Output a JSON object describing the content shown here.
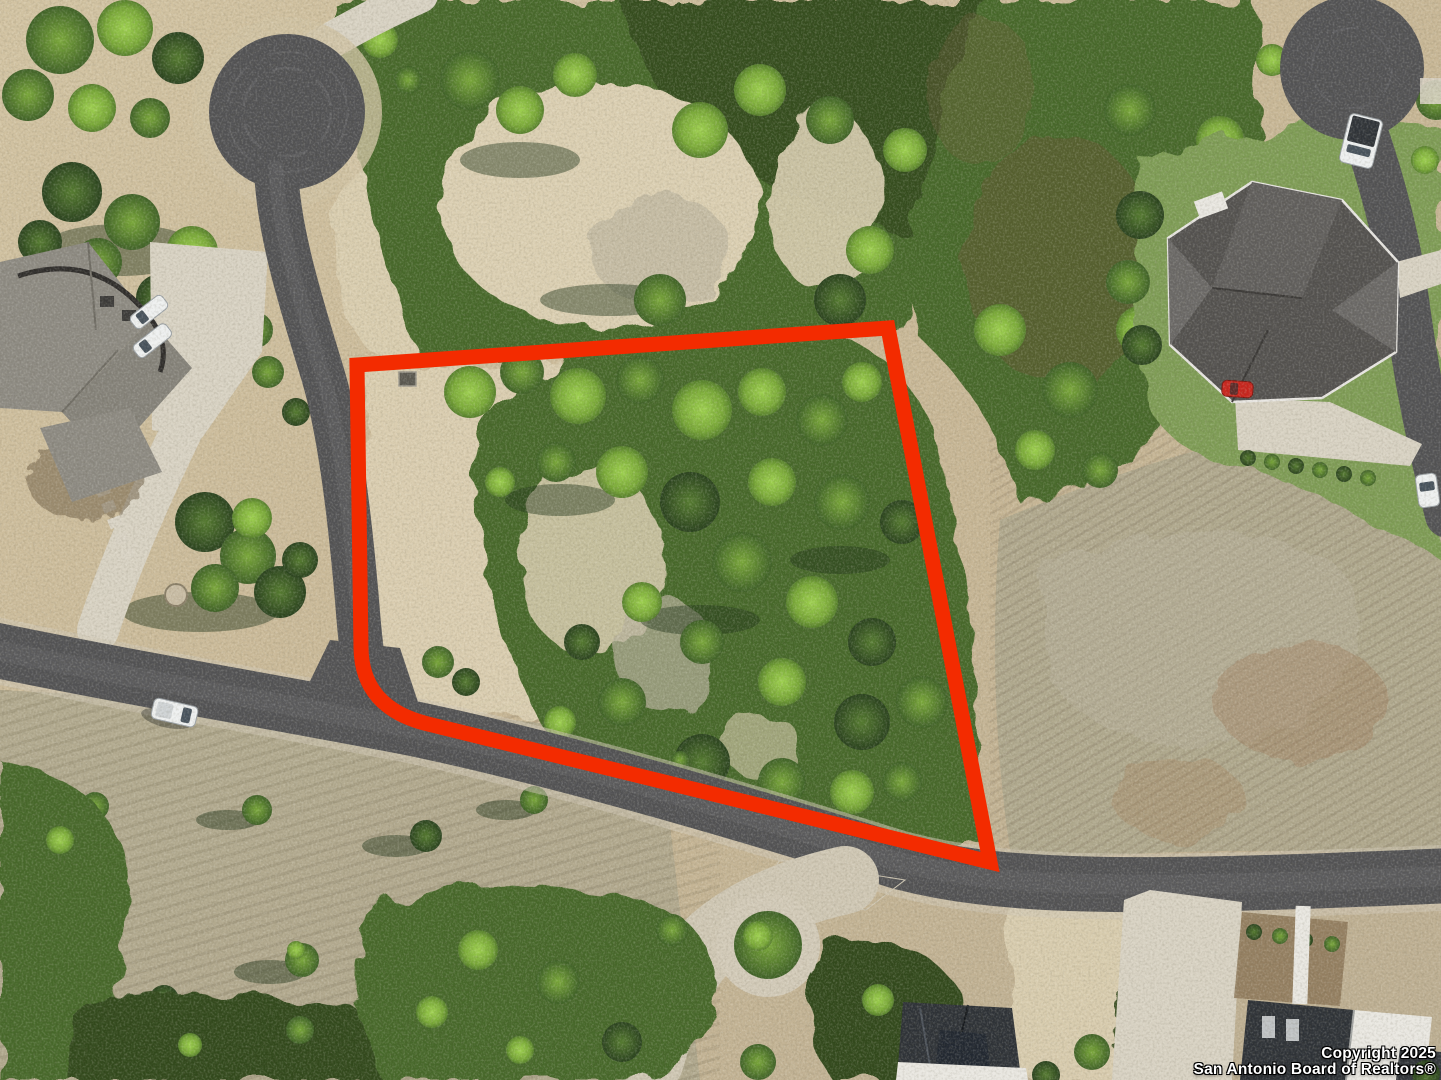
{
  "image": {
    "type": "aerial-drone-photo",
    "subject": "Vacant wooded residential lot for sale, outlined in red, Texas hill-country subdivision",
    "width": 1441,
    "height": 1080
  },
  "watermark": {
    "line1": "Copyright 2025",
    "line2": "San Antonio Board of Realtors®",
    "text_color": "#ffffff"
  },
  "lot_boundary": {
    "color": "#f32b00",
    "stroke_width": 15,
    "path": "M357,365 L888,328 L990,862 L428,724 Q362,708 361,648 L357,365 Z"
  },
  "colors": {
    "asphalt": "#525254",
    "concrete": "#d8d2c3",
    "dirt": "#c9b897",
    "tree_bright": "#8cc043",
    "tree_dark": "#2c4720",
    "lawn": "#7e9c55"
  },
  "scene": {
    "roads": [
      {
        "name": "cul-de-sac-top-left",
        "shape": "bulb",
        "center": [
          287,
          112
        ]
      },
      {
        "name": "street-north-south",
        "from": [
          276,
          168
        ],
        "to": [
          372,
          706
        ]
      },
      {
        "name": "street-main-diagonal",
        "from": [
          0,
          648
        ],
        "to": [
          1441,
          876
        ]
      },
      {
        "name": "cul-de-sac-top-right",
        "shape": "bulb",
        "center": [
          1352,
          68
        ]
      },
      {
        "name": "street-right-edge",
        "from": [
          1352,
          95
        ],
        "to": [
          1441,
          510
        ]
      }
    ],
    "houses": [
      {
        "name": "house-left",
        "roof": "gray-shingle",
        "area": [
          0,
          235,
          200,
          500
        ]
      },
      {
        "name": "house-top-right",
        "roof": "dark-gray-shingle",
        "area": [
          1165,
          180,
          1400,
          405
        ]
      },
      {
        "name": "house-bottom-center",
        "roof": "charcoal",
        "area": [
          895,
          1000,
          1030,
          1080
        ]
      },
      {
        "name": "house-bottom-right",
        "roof": "charcoal-and-white-modern",
        "area": [
          1240,
          905,
          1441,
          1080
        ]
      }
    ],
    "vehicles": [
      {
        "name": "white-pickup-on-road",
        "at": [
          174,
          713
        ]
      },
      {
        "name": "silver-car-left-driveway-1",
        "at": [
          149,
          312
        ]
      },
      {
        "name": "silver-car-left-driveway-2",
        "at": [
          152,
          341
        ]
      },
      {
        "name": "white-truck-top-right-cul-de-sac",
        "at": [
          1361,
          141
        ]
      },
      {
        "name": "red-car-top-right-house",
        "at": [
          1237,
          389
        ]
      },
      {
        "name": "white-car-right-edge",
        "at": [
          1427,
          490
        ]
      }
    ],
    "landmarks": [
      {
        "name": "small-shed-inside-lot",
        "at": [
          407,
          379
        ]
      },
      {
        "name": "landscaped-circle-island",
        "at": [
          768,
          945
        ]
      }
    ]
  }
}
